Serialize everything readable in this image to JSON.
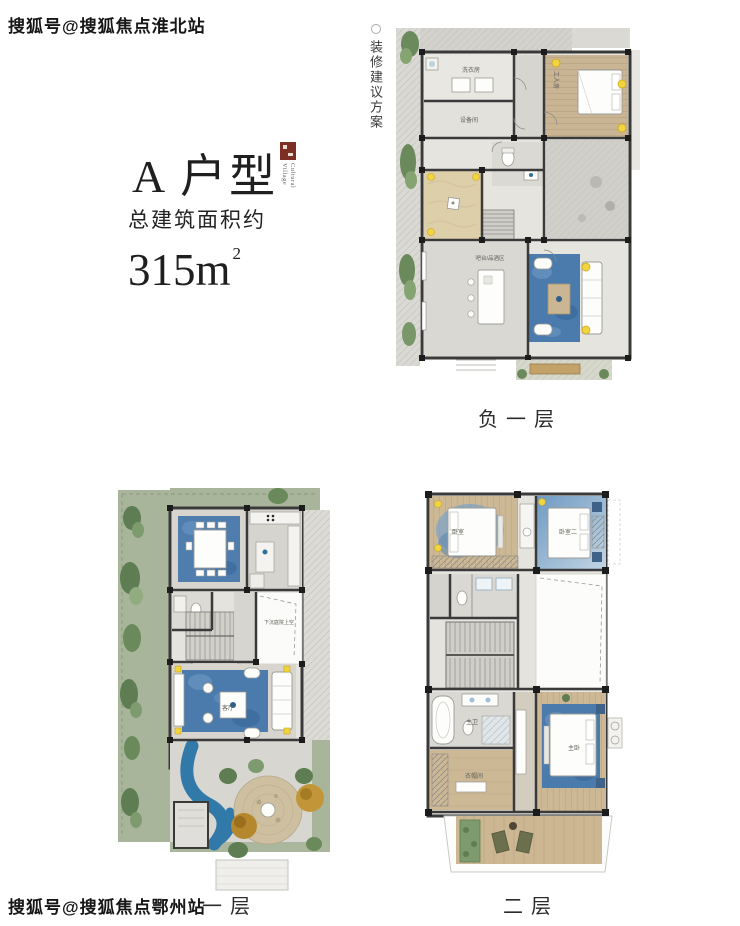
{
  "watermarks": {
    "top": "搜狐号@搜狐焦点淮北站",
    "bottom": "搜狐号@搜狐焦点鄂州站"
  },
  "header": {
    "title": "A 户型",
    "subtitle": "总建筑面积约",
    "area_number": "315m",
    "area_exponent": "2"
  },
  "logo": {
    "line1": "Cultural",
    "line2": "Village"
  },
  "side_note": "装修建议方案",
  "floors": {
    "basement": {
      "caption": "负一层",
      "rooms": {
        "laundry": "洗衣房",
        "equipment": "设备间",
        "worker": "工人房",
        "bar": "吧台/品酒区"
      }
    },
    "first": {
      "caption": "一层",
      "rooms": {
        "living": "客厅",
        "void": "下沉庭院上空"
      }
    },
    "second": {
      "caption": "二层",
      "rooms": {
        "bedroom1": "卧室",
        "bedroom2": "卧室二",
        "master_bath": "主卫",
        "closet": "衣帽间",
        "master": "主卧"
      }
    }
  },
  "colors": {
    "wall": "#3a3a3a",
    "rug_blue": "#4b7bac",
    "water_blue": "#3179a8",
    "lawn_green": "#a8b59b",
    "wood": "#cdb896",
    "accent_yellow": "#f1d43e",
    "seal_red": "#7d2f23"
  }
}
